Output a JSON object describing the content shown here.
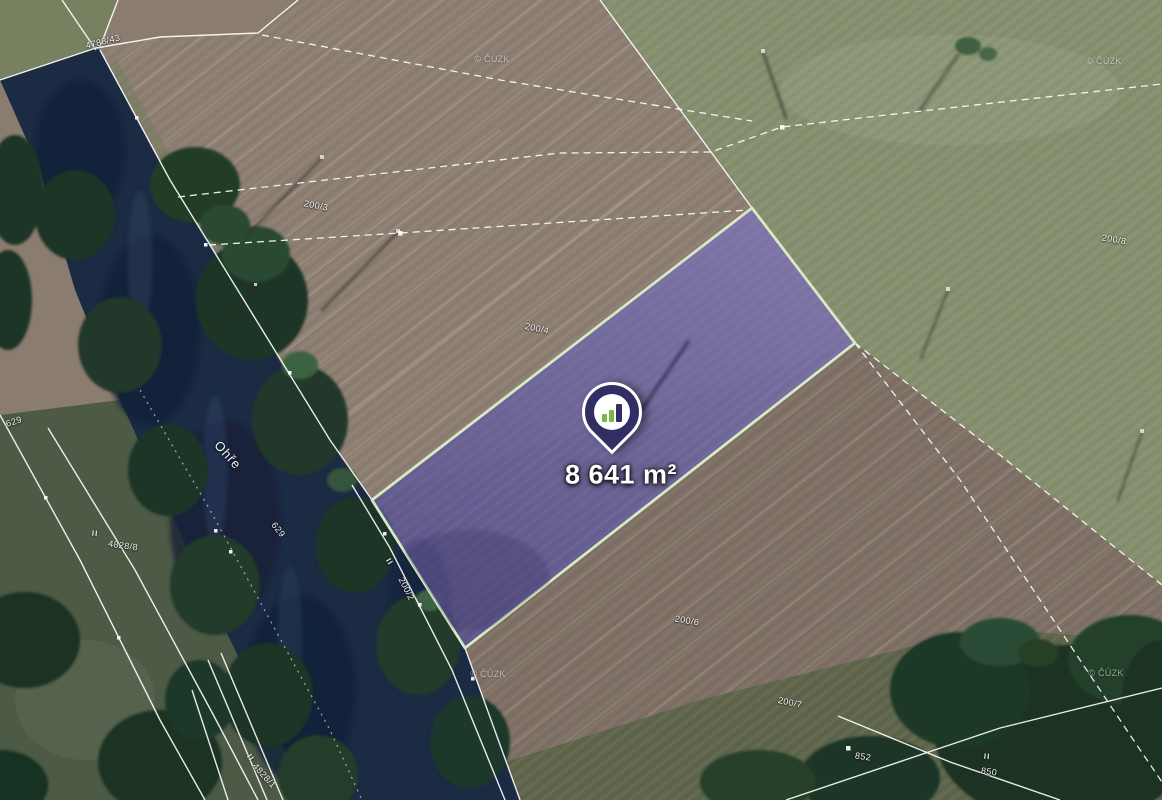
{
  "map": {
    "area_label": "8 641 m²",
    "river_label": "Ohře",
    "copyright_label": "© ČÚZK",
    "pin": {
      "icon": "bar-chart-logo"
    },
    "parcel_labels": [
      {
        "text": "4788/43"
      },
      {
        "text": "200/3"
      },
      {
        "text": "200/4"
      },
      {
        "text": "200/8"
      },
      {
        "text": "200/2"
      },
      {
        "text": "200/6"
      },
      {
        "text": "200/7"
      },
      {
        "text": "852"
      },
      {
        "text": "850"
      },
      {
        "text": "629"
      },
      {
        "text": "629"
      },
      {
        "text": "4828/8"
      },
      {
        "text": "4828/1"
      }
    ],
    "boundary_marks": [
      {
        "text": "II"
      },
      {
        "text": "II"
      },
      {
        "text": "II"
      },
      {
        "text": "II"
      }
    ],
    "colors": {
      "highlight_fill": "#6c63a6",
      "highlight_outline": "#d8e9c6",
      "pin_body": "#312e63",
      "pin_accent": "#7ab648",
      "boundary_line": "#ffffff"
    }
  }
}
